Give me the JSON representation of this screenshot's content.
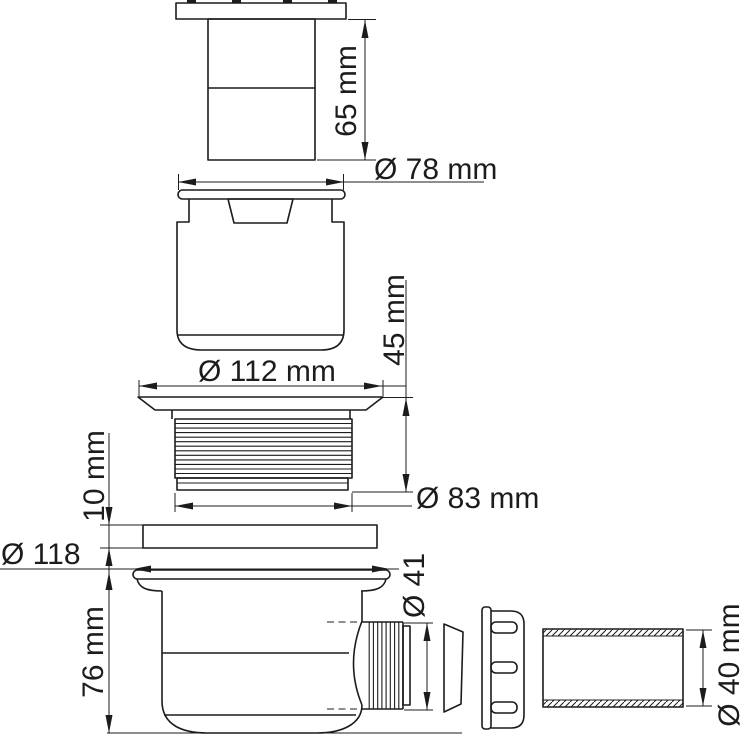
{
  "diagram": {
    "background": "#ffffff",
    "line_color": "#1c1c1c",
    "labels": {
      "cap_height": "65 mm",
      "cap_flange_dia": "Ø 78 mm",
      "insert_flange_dia": "Ø 112 mm",
      "insert_height": "45 mm",
      "thread_dia": "Ø 83 mm",
      "gasket_thickness": "10 mm",
      "body_flange_dia": "Ø 118",
      "body_height": "76 mm",
      "outlet_thread_dia": "Ø 41",
      "pipe_dia": "Ø 40 mm"
    }
  }
}
